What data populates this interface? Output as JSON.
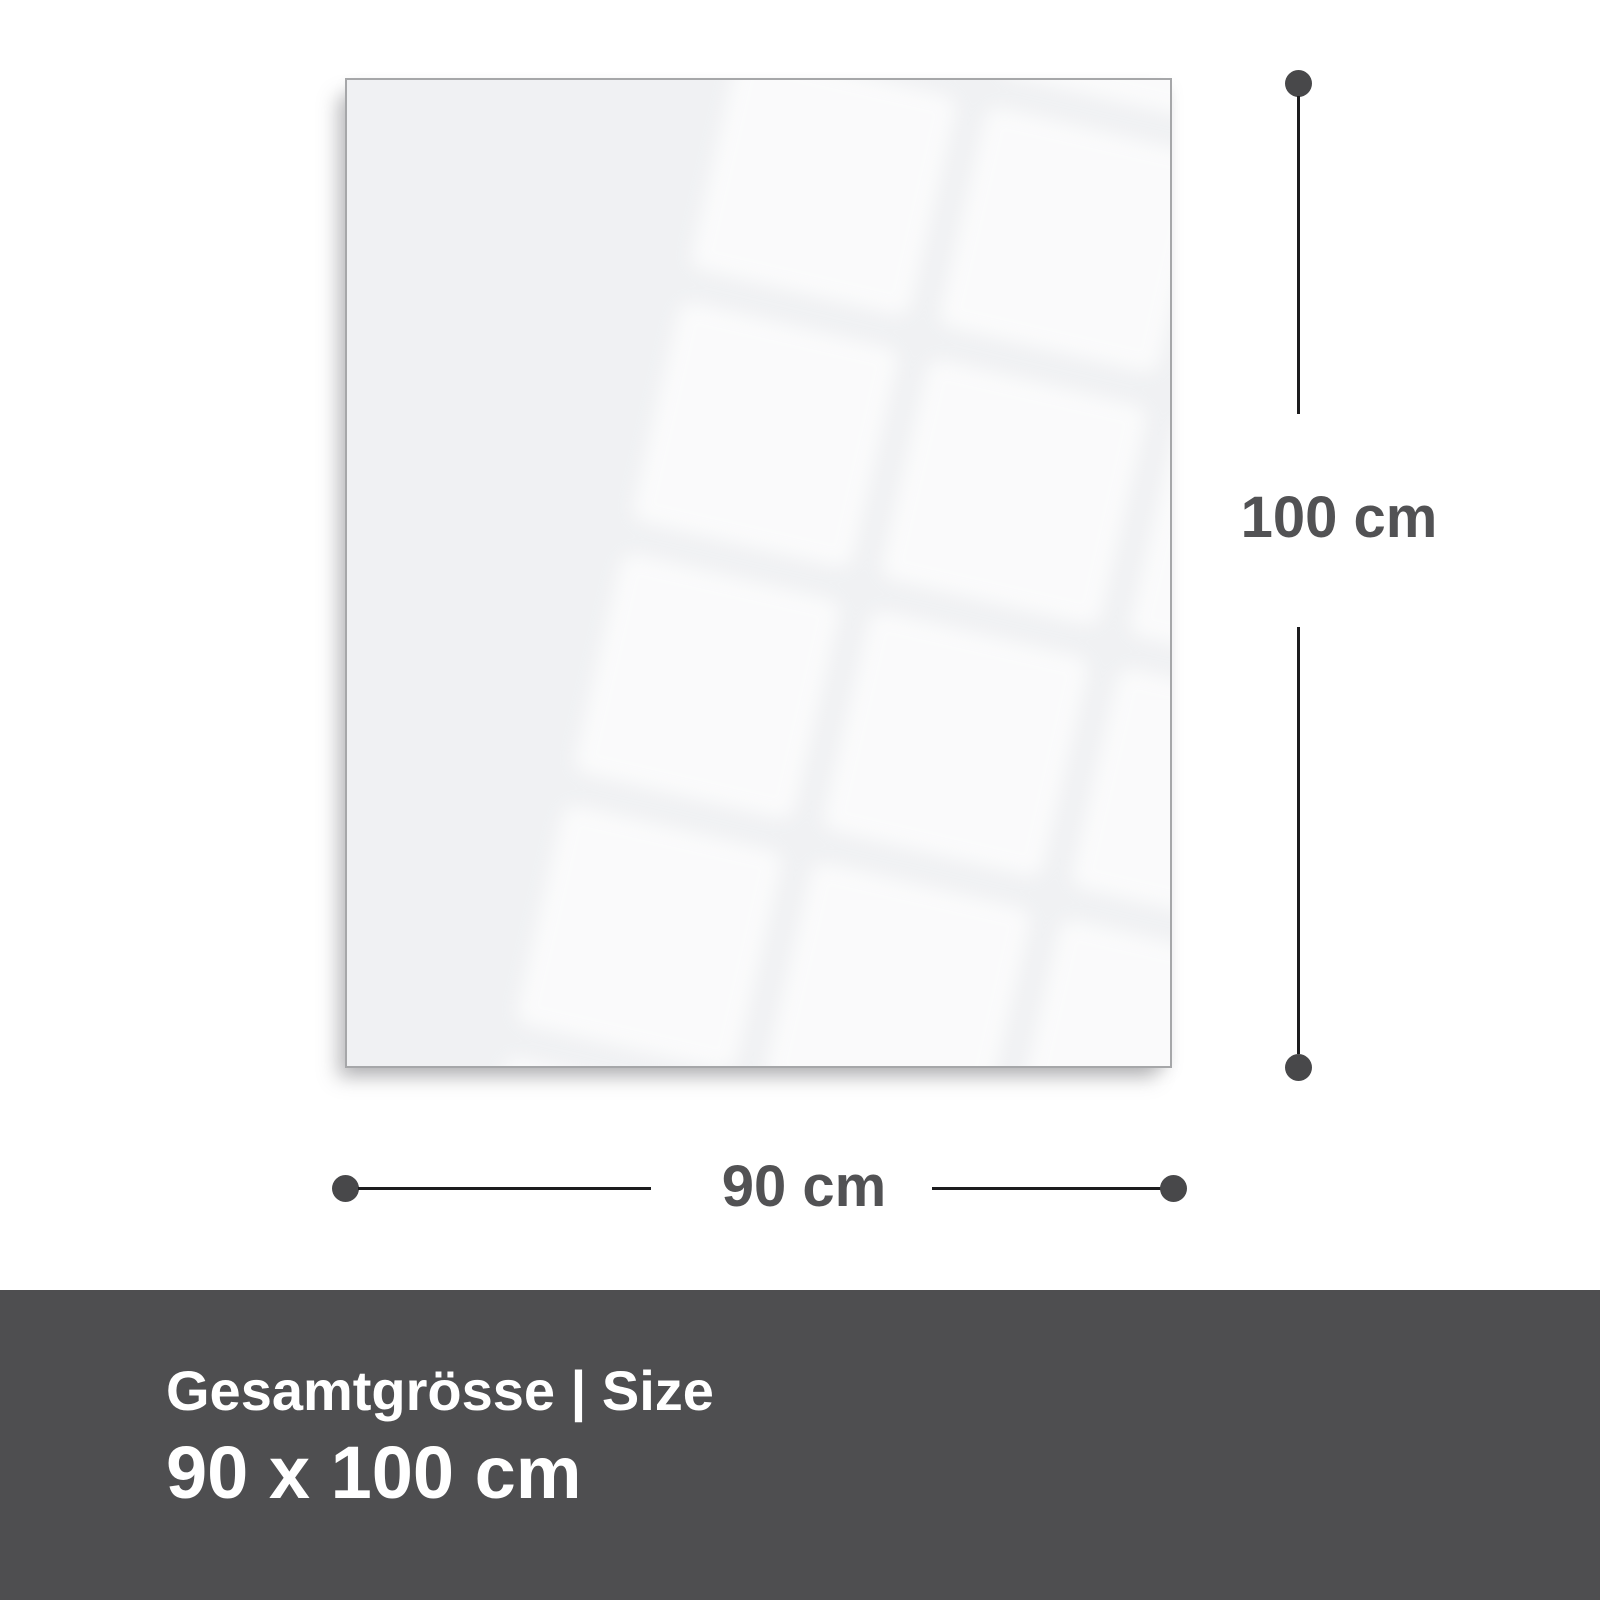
{
  "diagram": {
    "product": "glass-panel",
    "height_dimension": {
      "label": "100 cm"
    },
    "width_dimension": {
      "label": "90 cm"
    },
    "footer": {
      "title": "Gesamtgrösse | Size",
      "size": "90 x 100 cm"
    },
    "colors": {
      "panel_fill": "#f0f1f3",
      "panel_border": "#a6a7a9",
      "dimension_line": "#1c1c1e",
      "dimension_dot": "#48484a",
      "dimension_label_text": "#525254",
      "footer_background": "#4e4e50",
      "footer_text": "#ffffff"
    }
  }
}
